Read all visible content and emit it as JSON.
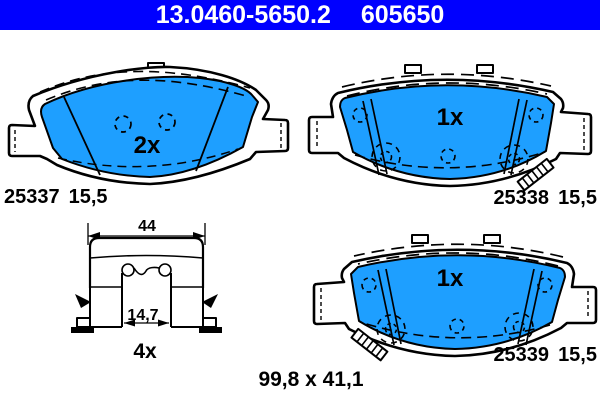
{
  "header": {
    "catalog_number": "13.0460-5650.2",
    "reference_number": "605650"
  },
  "colors": {
    "header_bg": "#0000ff",
    "header_text": "#ffffff",
    "pad_fill": "#1e9fff",
    "line": "#000000",
    "background": "#ffffff"
  },
  "pads": [
    {
      "position": "top-left",
      "quantity": "2x",
      "part_number": "25337",
      "thickness": "15,5"
    },
    {
      "position": "top-right",
      "quantity": "1x",
      "part_number": "25338",
      "thickness": "15,5"
    },
    {
      "position": "bottom-right",
      "quantity": "1x",
      "part_number": "25339",
      "thickness": "15,5"
    }
  ],
  "fitting_kit": {
    "quantity": "4x",
    "outer_width": "44",
    "inner_width": "14,7"
  },
  "overall_dimensions": "99,8 x 41,1"
}
